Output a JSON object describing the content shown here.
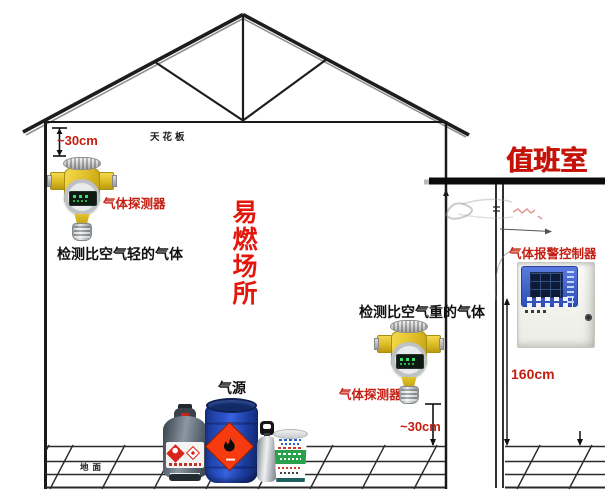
{
  "labels": {
    "ceiling": "天花板",
    "top_clearance": "~30cm",
    "detector_top": "气体探测器",
    "light_gas_note": "检测比空气轻的气体",
    "flammable_area": "易燃场所",
    "duty_room": "值班室",
    "controller": "气体报警控制器",
    "controller_height": "160cm",
    "heavy_gas_note": "检测比空气重的气体",
    "detector_bottom": "气体探测器",
    "bottom_clearance": "~30cm",
    "gas_source": "气源",
    "ground": "地面"
  },
  "colors": {
    "annotation_red": "#c41e12",
    "flammable_red": "#e4170c",
    "duty_room_red": "#c5130a",
    "structure_black": "#1a1a1a",
    "detector_yellow": "#e3c22c",
    "drum_blue": "#2b55cc",
    "hazard_diamond_orange": "#f63b10",
    "controller_panel_blue": "#3a5cc4",
    "lpg_gray": "#5d6a74",
    "bucket_green": "#27a14b"
  },
  "icons": {
    "gas_detector": "yellow-cross-gas-detector",
    "alarm_controller": "wall-mounted-controller-panel",
    "flame_symbol": "black-flame-on-orange-diamond",
    "lpg_cylinder": "gray-lpg-cylinder",
    "blue_drum": "blue-chemical-drum",
    "gas_bottle": "small-silver-gas-bottle",
    "paint_bucket": "paint-bucket-with-green-band"
  }
}
